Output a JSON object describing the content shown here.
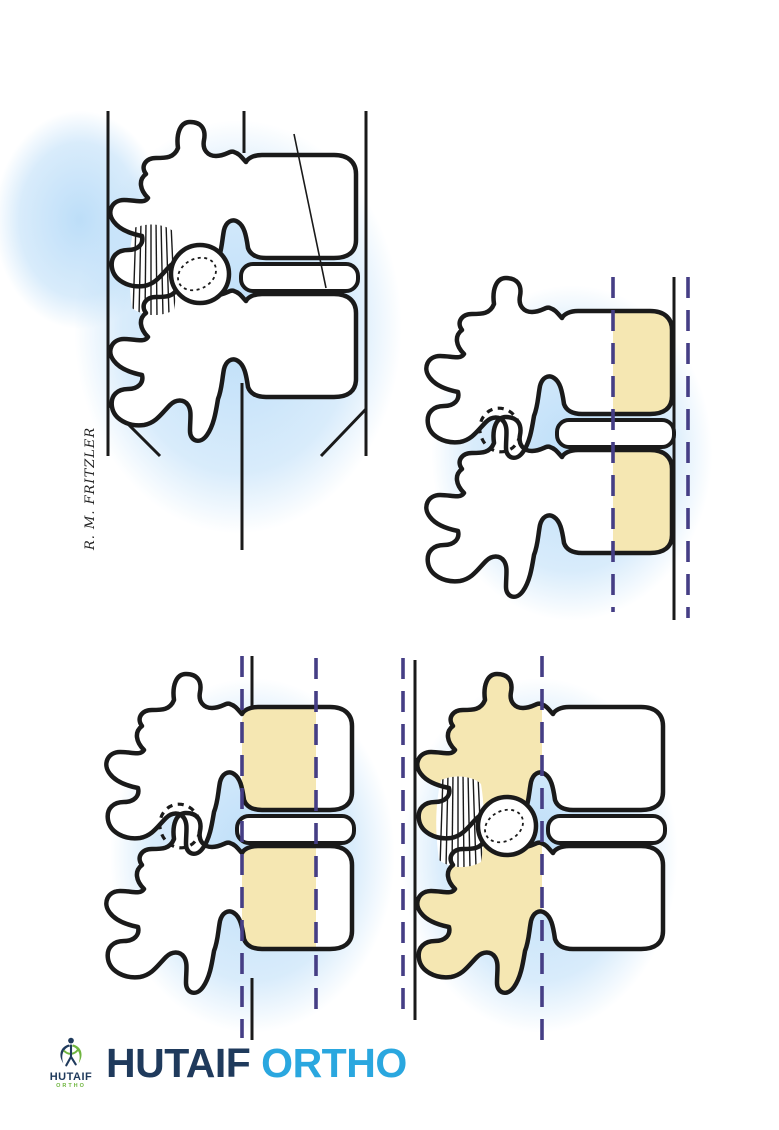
{
  "figure": {
    "signature": "R. M. FRITZLER"
  },
  "logo": {
    "icon_title": "HUTAIF",
    "icon_subtitle": "ORTHO",
    "wordmark": "HUTAIF",
    "wordmark_accent": "ORTHO"
  },
  "colors": {
    "background": "#ffffff",
    "line": "#1a1a1a",
    "bone": "#ffffff",
    "highlight_yellow": "#f5e7b2",
    "dash_purple": "#453e85",
    "glow_blue": "#b9dcf8",
    "logo_navy": "#1f3a5c",
    "logo_cyan": "#2aa7df",
    "logo_green": "#6fb53f"
  }
}
